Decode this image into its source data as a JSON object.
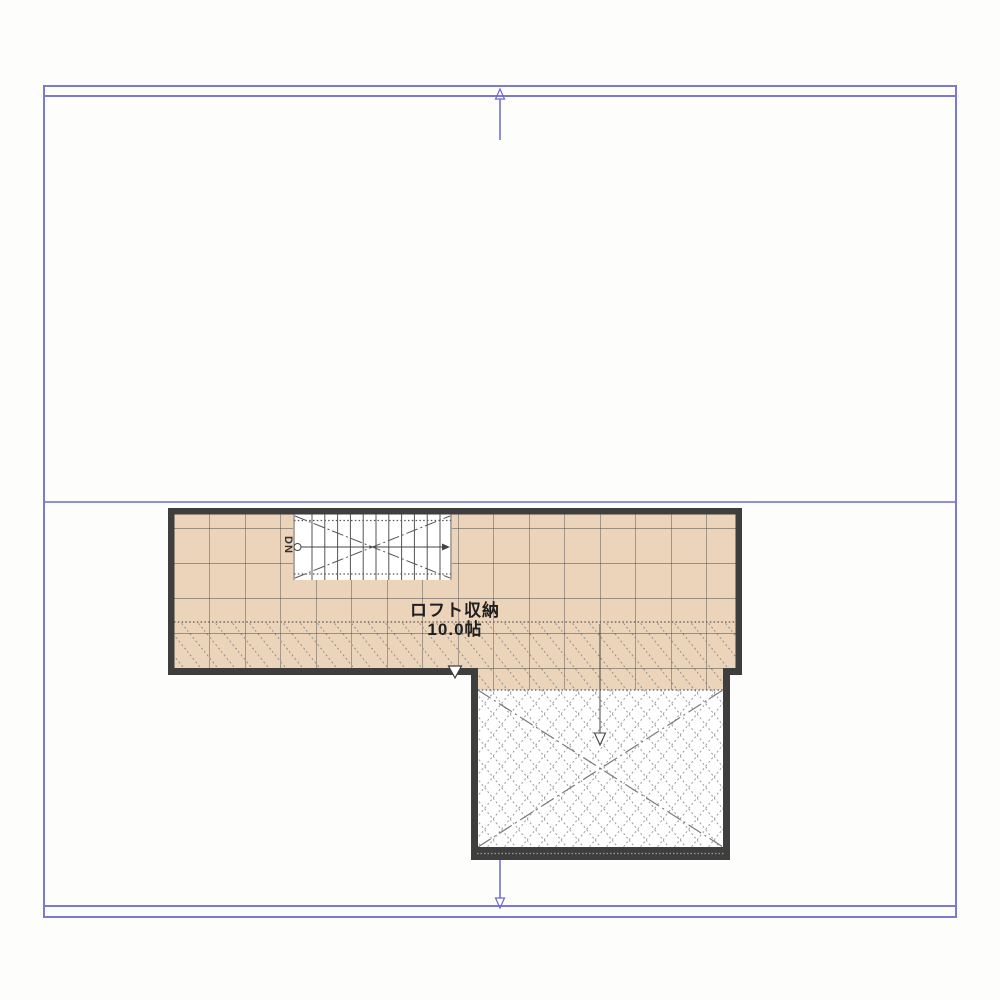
{
  "drawing": {
    "room": {
      "name": "ロフト収納",
      "area": "10.0帖"
    },
    "stair": {
      "dn_label": "DN"
    },
    "colors": {
      "frame_blue": "#7b79d3",
      "axis_blue": "#918fd9",
      "arrow_blue": "#6c69ce",
      "floor_tan": "#ecd4ba",
      "wall_dark": "#3e3e3e",
      "grid_line": "#4a4a4a",
      "hatch_gray": "#8e8e8e"
    }
  }
}
